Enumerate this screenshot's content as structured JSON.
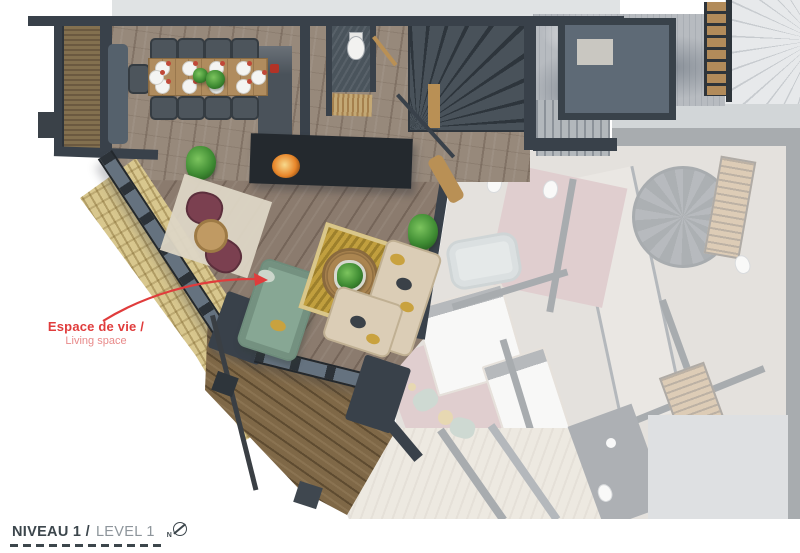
{
  "annotation": {
    "label_fr": "Espace de vie /",
    "label_en": "Living space"
  },
  "legend": {
    "level_fr": "NIVEAU 1 /",
    "level_en": "LEVEL 1",
    "compass_north": "N"
  },
  "colors": {
    "accent_red": "#e03c3c",
    "accent_red_light": "#e88a8a",
    "ink": "#3c464c",
    "ink_muted": "#8d959b",
    "wall": "#39414a",
    "wood_floor": "#97897b",
    "wood_living": "#8b7b6e",
    "deck_wood": "#7f6847",
    "straw_roof": "#d8c78e",
    "concrete": "#b7bbc0",
    "sofa_green": "#87a794",
    "sofa_beige": "#dbcdb6",
    "rug_gold": "#c19f3e",
    "armchair_burgundy": "#7b4050",
    "carpet_pink": "#b98f93",
    "fire_orange": "#e8862a",
    "plant_green": "#3f8c33"
  }
}
